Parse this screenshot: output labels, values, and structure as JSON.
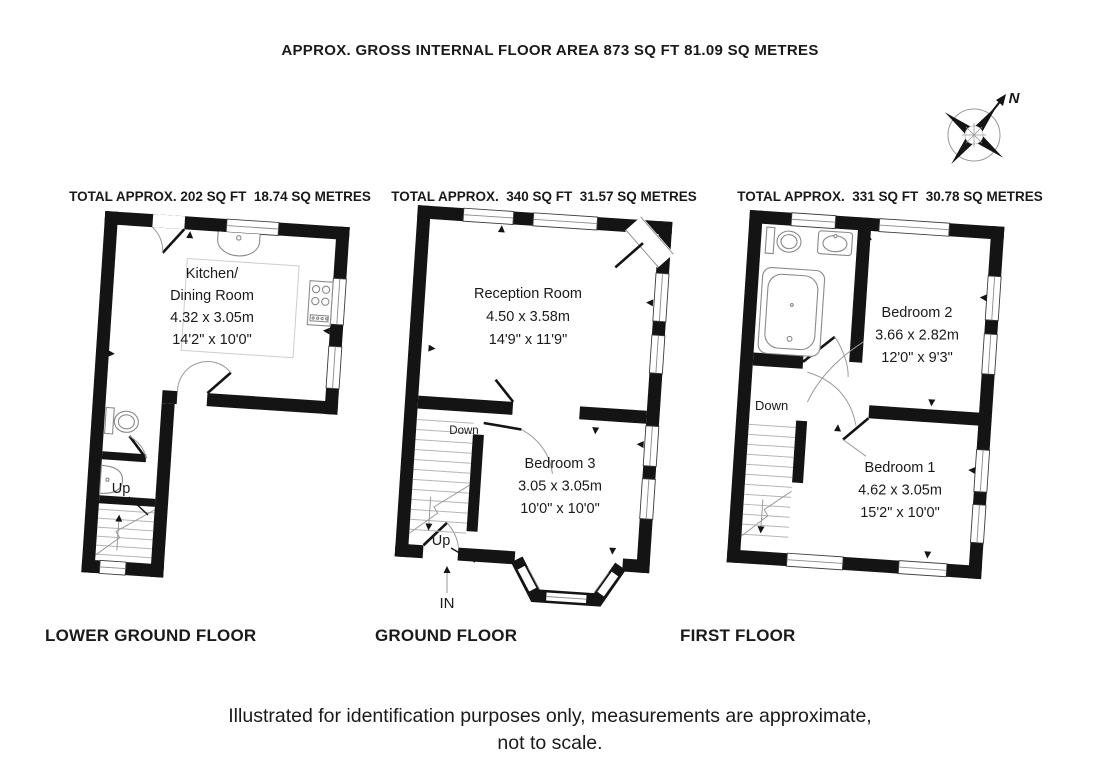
{
  "header": {
    "title": "APPROX. GROSS INTERNAL FLOOR AREA 873 SQ FT 81.09 SQ METRES"
  },
  "compass": {
    "north": "N"
  },
  "floors": {
    "lower_ground": {
      "total": "TOTAL APPROX. 202 SQ FT  18.74 SQ METRES",
      "name": "LOWER GROUND FLOOR",
      "kitchen": {
        "line1": "Kitchen/",
        "line2": "Dining Room",
        "metric": "4.32 x 3.05m",
        "imperial": "14'2\" x 10'0\""
      },
      "up": "Up"
    },
    "ground": {
      "total": "TOTAL APPROX.  340 SQ FT  31.57 SQ METRES",
      "name": "GROUND FLOOR",
      "reception": {
        "line1": "Reception Room",
        "metric": "4.50 x 3.58m",
        "imperial": "14'9\" x 11'9\""
      },
      "bedroom3": {
        "line1": "Bedroom 3",
        "metric": "3.05 x 3.05m",
        "imperial": "10'0\" x 10'0\""
      },
      "down": "Down",
      "up": "Up",
      "entrance": "IN"
    },
    "first": {
      "total": "TOTAL APPROX.  331 SQ FT  30.78 SQ METRES",
      "name": "FIRST FLOOR",
      "bedroom2": {
        "line1": "Bedroom 2",
        "metric": "3.66 x 2.82m",
        "imperial": "12'0\" x 9'3\""
      },
      "bedroom1": {
        "line1": "Bedroom 1",
        "metric": "4.62 x 3.05m",
        "imperial": "15'2\" x 10'0\""
      },
      "down": "Down"
    }
  },
  "footer": {
    "line1": "Illustrated for identification purposes only, measurements are approximate,",
    "line2": "not to scale."
  }
}
